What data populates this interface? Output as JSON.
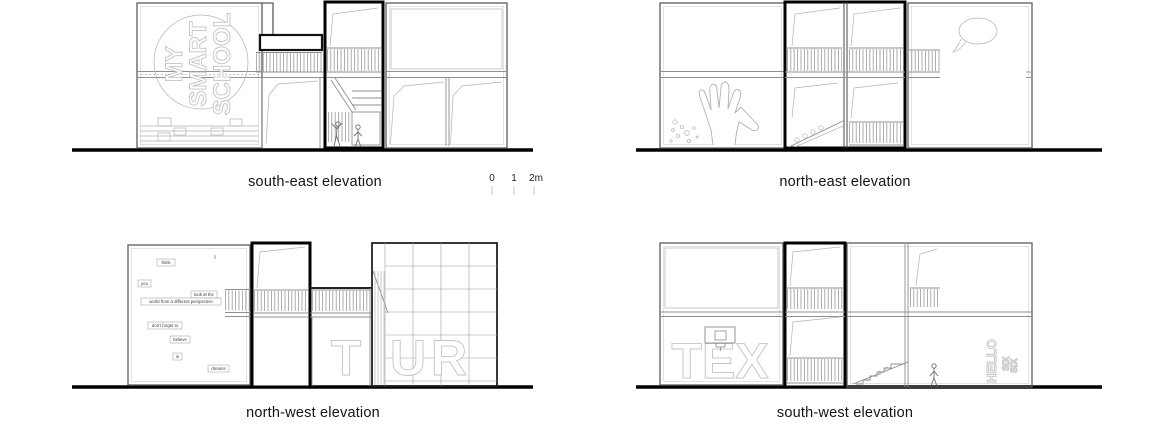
{
  "sheet": {
    "background": "#ffffff",
    "panels": [
      {
        "id": "south-east",
        "title": "south-east elevation"
      },
      {
        "id": "north-east",
        "title": "north-east elevation"
      },
      {
        "id": "north-west",
        "title": "north-west elevation"
      },
      {
        "id": "south-west",
        "title": "south-west elevation"
      }
    ],
    "scale_bar": {
      "labels": [
        "0",
        "1",
        "2m"
      ]
    }
  },
  "graffiti": {
    "smart_school": [
      "MY",
      "SMART",
      "SCHOOL"
    ],
    "tur": [
      "T",
      "U",
      "R"
    ],
    "tex": "TEX",
    "hello": "HELLO",
    "six": "SIX"
  },
  "quote": {
    "think": "think",
    "you": "you",
    "look_at_the": "look at the",
    "world_perspective": "world from a different perspective",
    "dont_forget_to": "don't forget to",
    "believe": "believe",
    "in": "in",
    "dreams": "dreams"
  },
  "colors": {
    "line": "#9a9a9a",
    "wall": "#5c5c5c",
    "dark_frame": "#000000",
    "ground": "#000000",
    "glyph_outline": "#c4c4c4",
    "title_text": "#141414"
  }
}
